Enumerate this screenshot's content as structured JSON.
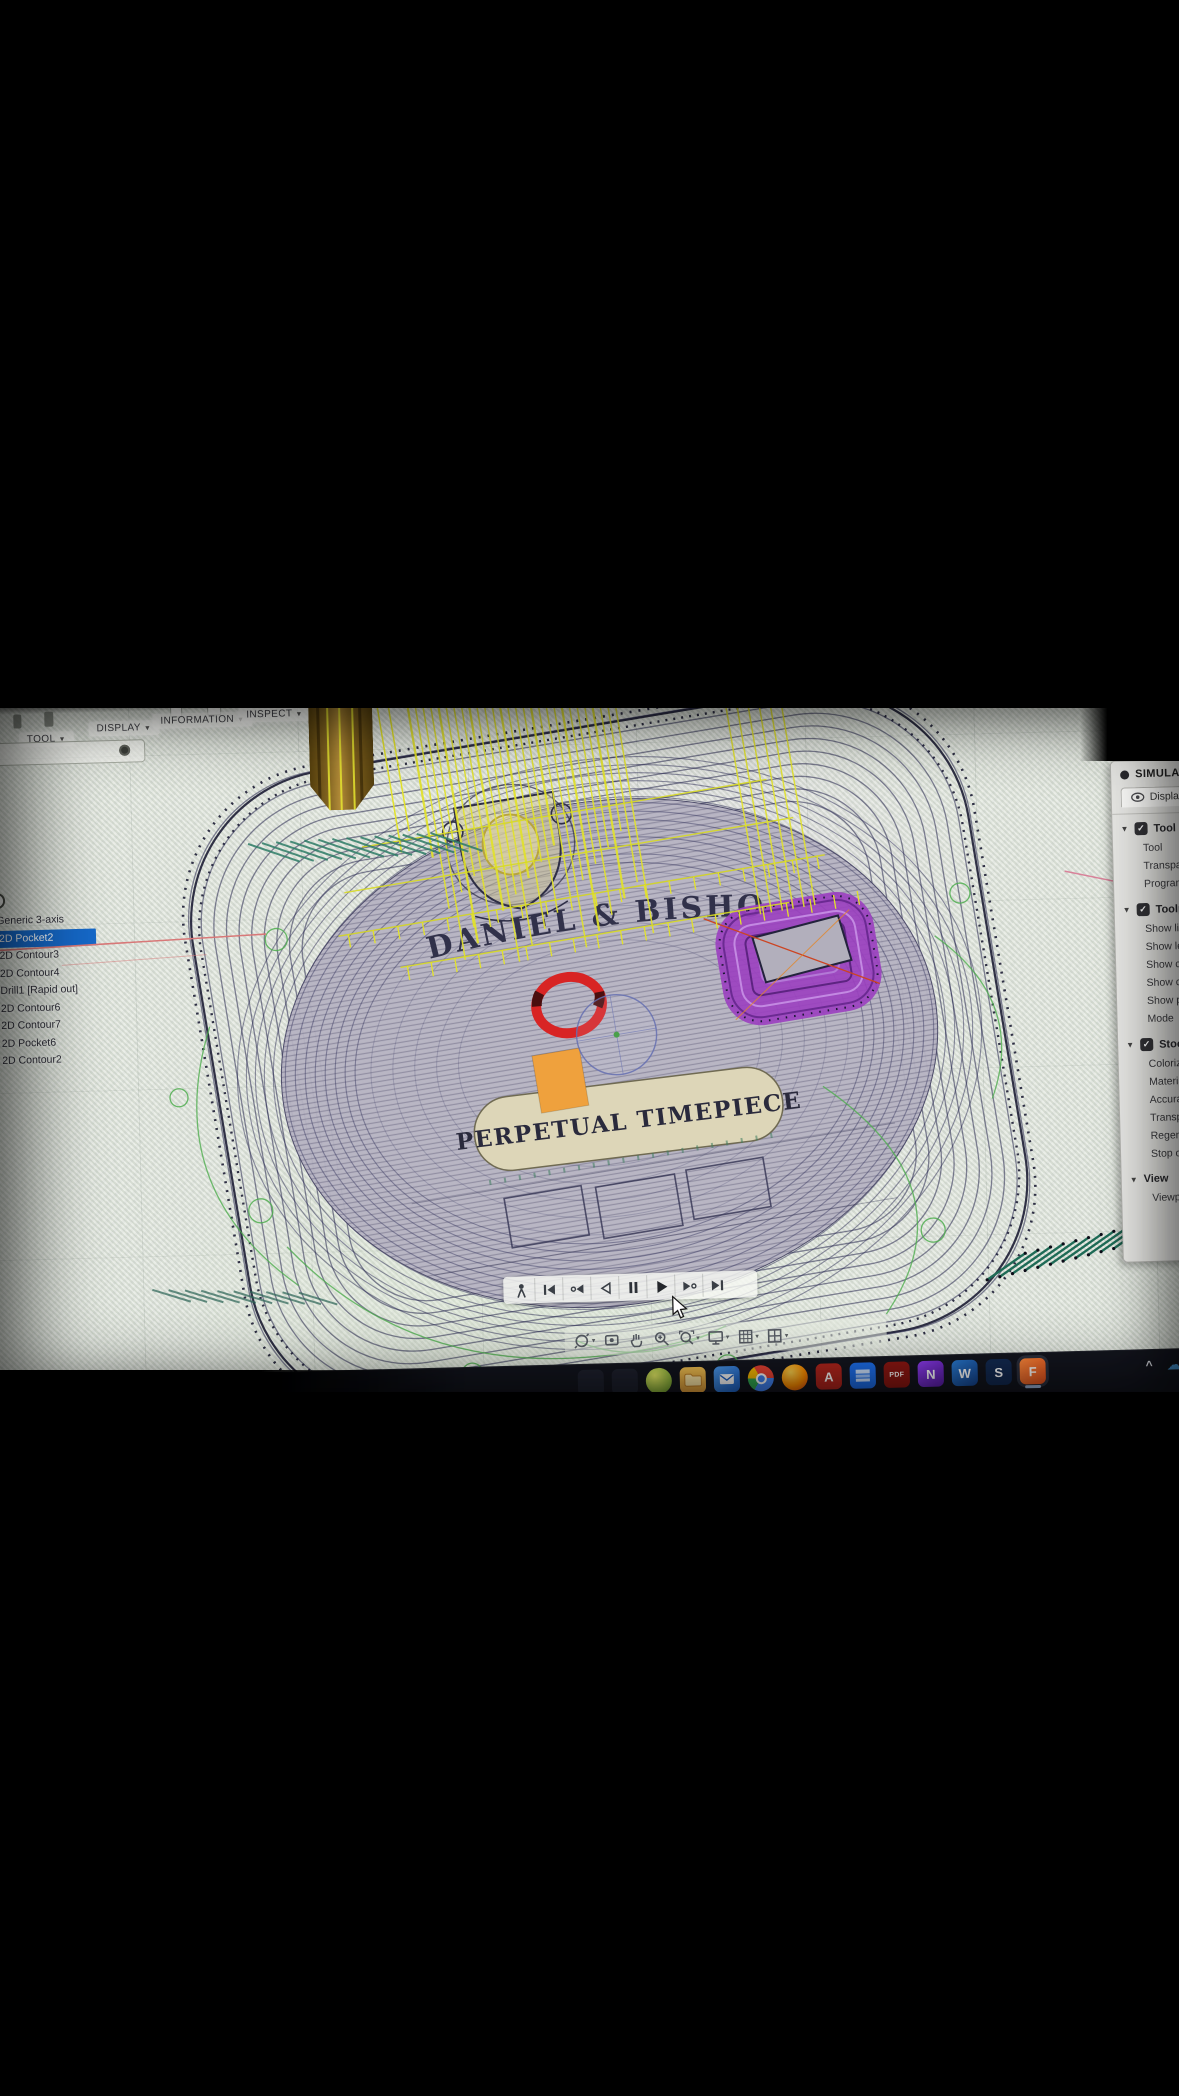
{
  "ui": {
    "caret_down": "▼",
    "check": "✓",
    "info_symbol": "i"
  },
  "toolbar": {
    "menus": [
      {
        "label": "TOOL"
      },
      {
        "label": "DISPLAY"
      },
      {
        "label": "INFORMATION"
      },
      {
        "label": "INSPECT"
      }
    ]
  },
  "browser": {
    "chip": "p3",
    "machine": "Autodesk Generic 3-axis",
    "operations": [
      {
        "label": "[T1] 2D Pocket2",
        "selected": true
      },
      {
        "label": "[T3] 2D Contour3",
        "selected": false
      },
      {
        "label": "[T3] 2D Contour4",
        "selected": false
      },
      {
        "label": "[T5] Drill1 [Rapid out]",
        "selected": false
      },
      {
        "label": "[T2] 2D Contour6",
        "selected": false
      },
      {
        "label": "[T2] 2D Contour7",
        "selected": false
      },
      {
        "label": "[T3] 2D Pocket6",
        "selected": false
      },
      {
        "label": "[T2] 2D Contour2",
        "selected": false
      }
    ]
  },
  "simulate_panel": {
    "title": "SIMULATE",
    "tabs": {
      "display": "Display",
      "info": "i"
    },
    "sections": [
      {
        "title": "Tool",
        "has_checkbox": true,
        "rows": [
          "Tool",
          "Transparent",
          "Programmed Point"
        ]
      },
      {
        "title": "Toolpath",
        "has_checkbox": true,
        "rows": [
          "Show links",
          "Show leads",
          "Show cutting moves",
          "Show connections",
          "Show points",
          "Mode"
        ]
      },
      {
        "title": "Stock",
        "has_checkbox": true,
        "rows": [
          "Colorization",
          "Material",
          "Accuracy",
          "Transparent",
          "Regenerate",
          "Stop on collision"
        ]
      },
      {
        "title": "View",
        "has_checkbox": false,
        "rows": [
          "Viewpoint"
        ]
      }
    ]
  },
  "scene": {
    "arc_text": "DANIEL & BISHOP",
    "plaque_text": "PERPETUAL TIMEPIECE",
    "colors": {
      "toolpath_blue": "#26264e",
      "toolpath_blue_dark": "#10102a",
      "toolpath_yellow": "#e2e22b",
      "toolpath_green": "#4fae4f",
      "hatch_teal": "#2d7c66",
      "pocket_purple": "#9b3fc0",
      "alert_red": "#d82424",
      "stock_face": "#b7b4c3",
      "plaque": "#ddd6b8",
      "highlight_orange": "#efa13d",
      "link_red": "#d87878"
    }
  },
  "player": {
    "icons": [
      "walkthrough",
      "skip-to-start",
      "previous-operation",
      "play-backward",
      "pause",
      "play",
      "next-operation",
      "skip-to-end"
    ]
  },
  "navbar": {
    "icons": [
      "orbit",
      "look-at",
      "pan",
      "zoom",
      "fit",
      "display-settings",
      "grid-and-snaps",
      "viewports"
    ]
  },
  "taskbar": {
    "apps": [
      {
        "name": "app-sphere",
        "glyph": ""
      },
      {
        "name": "file-explorer",
        "glyph": ""
      },
      {
        "name": "mail",
        "glyph": ""
      },
      {
        "name": "chrome",
        "glyph": ""
      },
      {
        "name": "firefox",
        "glyph": ""
      },
      {
        "name": "autodesk-app",
        "glyph": "A"
      },
      {
        "name": "remote-desktop",
        "glyph": ""
      },
      {
        "name": "acrobat",
        "glyph": "PDF"
      },
      {
        "name": "purple-app",
        "glyph": "N"
      },
      {
        "name": "word",
        "glyph": "W"
      },
      {
        "name": "s-app",
        "glyph": "S"
      },
      {
        "name": "fusion-360",
        "glyph": "F",
        "active": true
      }
    ],
    "tray": {
      "expand_glyph": "^",
      "cloud_glyph": "☁"
    }
  }
}
